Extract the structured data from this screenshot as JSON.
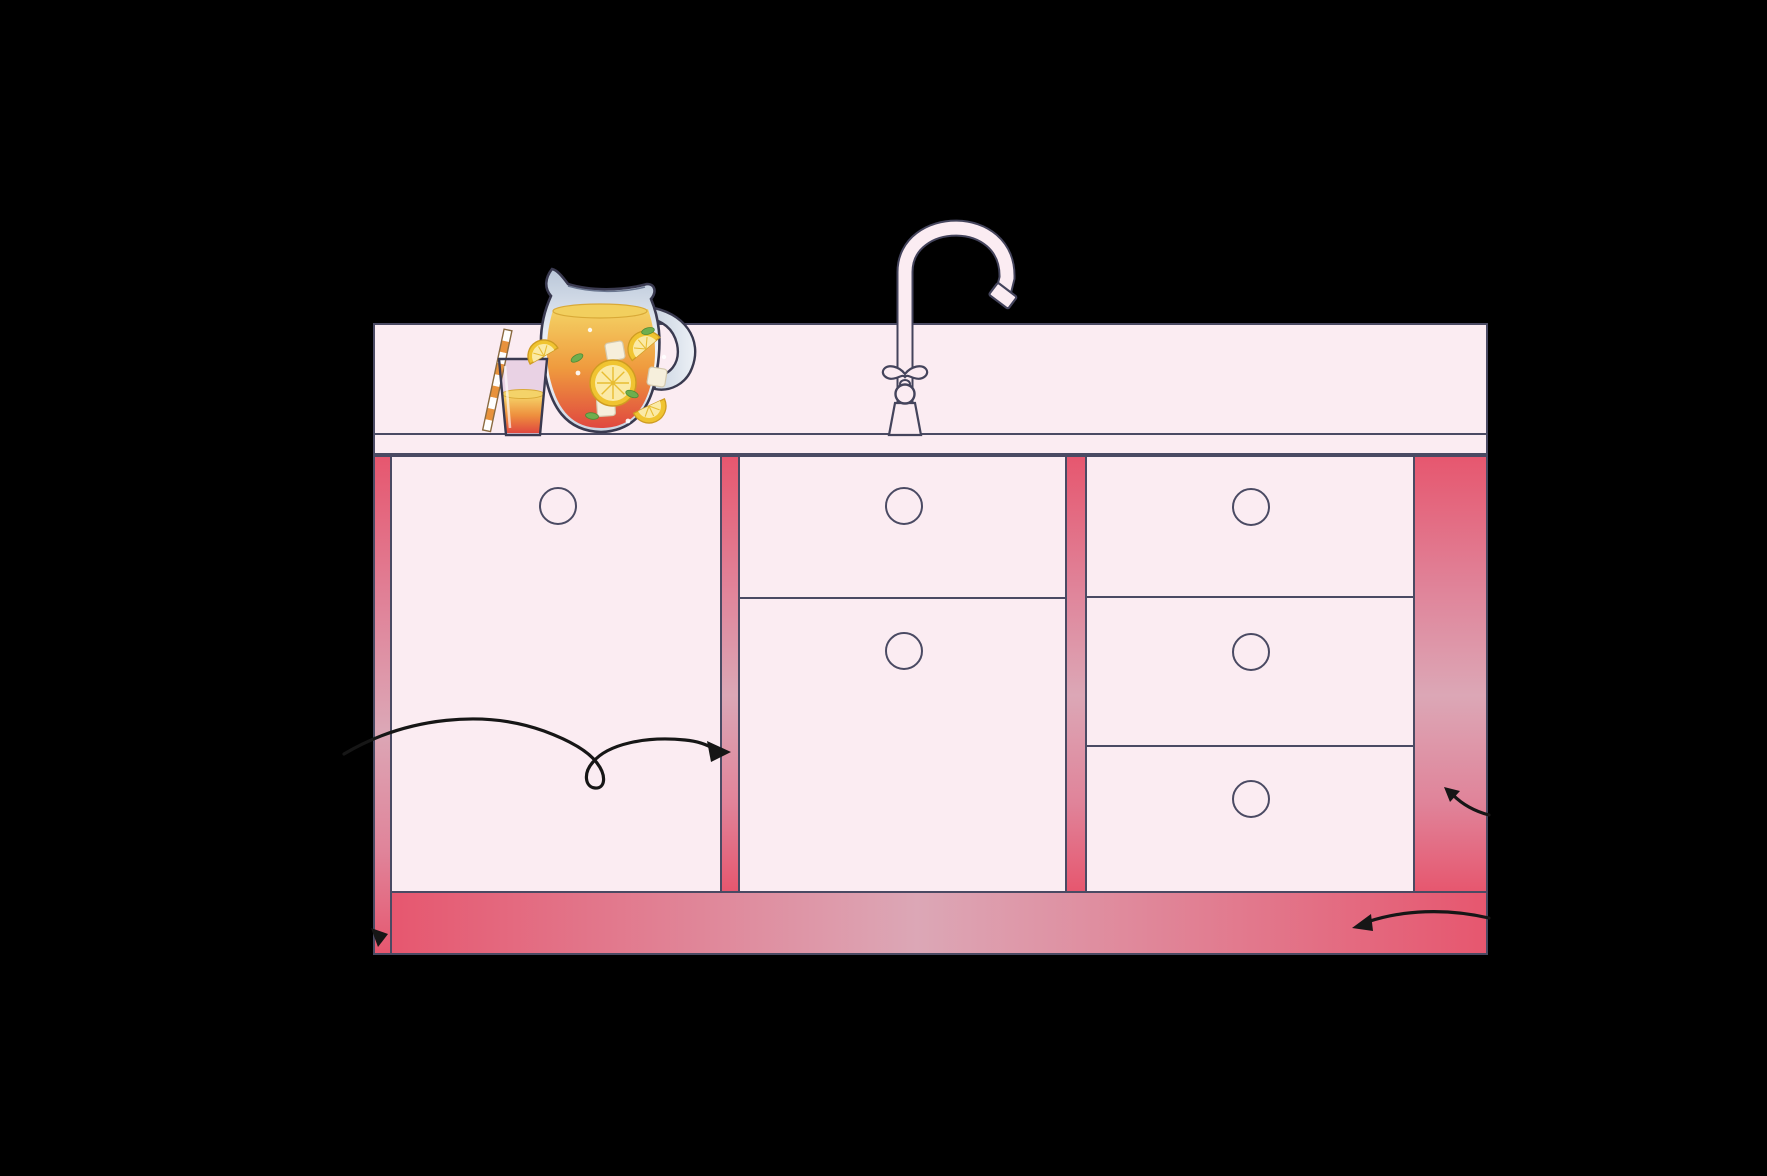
{
  "scene": {
    "title": "Kitchen sink base cabinet illustration with callout arrows",
    "background": "#000000"
  },
  "colors": {
    "scene_bg": "#000000",
    "cabinet_face_pink": "#fbecf2",
    "frame_red": "#e6576f",
    "frame_red_mid": "#e08399",
    "frame_red_soft": "#dca7b6",
    "outline_slate": "#4a4a63",
    "arrow_black": "#161616",
    "liquid_yellow": "#f4d264",
    "liquid_orange": "#ee8f3e",
    "liquid_red": "#e0483f",
    "lemon_rind": "#f0c431",
    "lemon_flesh": "#fbeaa6",
    "mint_green": "#6fae4e",
    "glass_blue": "#b9c6d8"
  },
  "counter_items": {
    "faucet": {
      "icon": "gooseneck-faucet-icon",
      "style": "tall curved spout with ornate handle on flared base"
    },
    "pitcher": {
      "icon": "lemonade-pitcher-icon",
      "contents": "orange drink with lemon slices, ice cubes, mint leaves"
    },
    "glass": {
      "icon": "juice-glass-icon",
      "contents": "orange drink",
      "garnish": [
        "striped straw",
        "lemon wedge on rim"
      ]
    }
  },
  "cabinet": {
    "left_section": {
      "type": "door",
      "knobs": 1
    },
    "middle_section": {
      "top": {
        "type": "drawer",
        "knobs": 1
      },
      "bottom": {
        "type": "door",
        "knobs": 1
      }
    },
    "right_section": {
      "type": "drawer stack",
      "drawers": 3,
      "knobs": 3
    },
    "vertical_stiles": 3,
    "right_end_panel": 1,
    "toe_kick": 1,
    "knob_total": 6
  },
  "arrows": [
    {
      "id": "loop-arrow",
      "shape": "curve with loop",
      "points_to": "center stile"
    },
    {
      "id": "right-panel-arrow",
      "shape": "short curve",
      "points_to": "right end panel"
    },
    {
      "id": "toe-kick-arrow",
      "shape": "long curve",
      "points_to": "toe kick"
    },
    {
      "id": "left-edge-arrowhead",
      "shape": "arrowhead only",
      "points_to": "left stile at toe kick"
    }
  ]
}
